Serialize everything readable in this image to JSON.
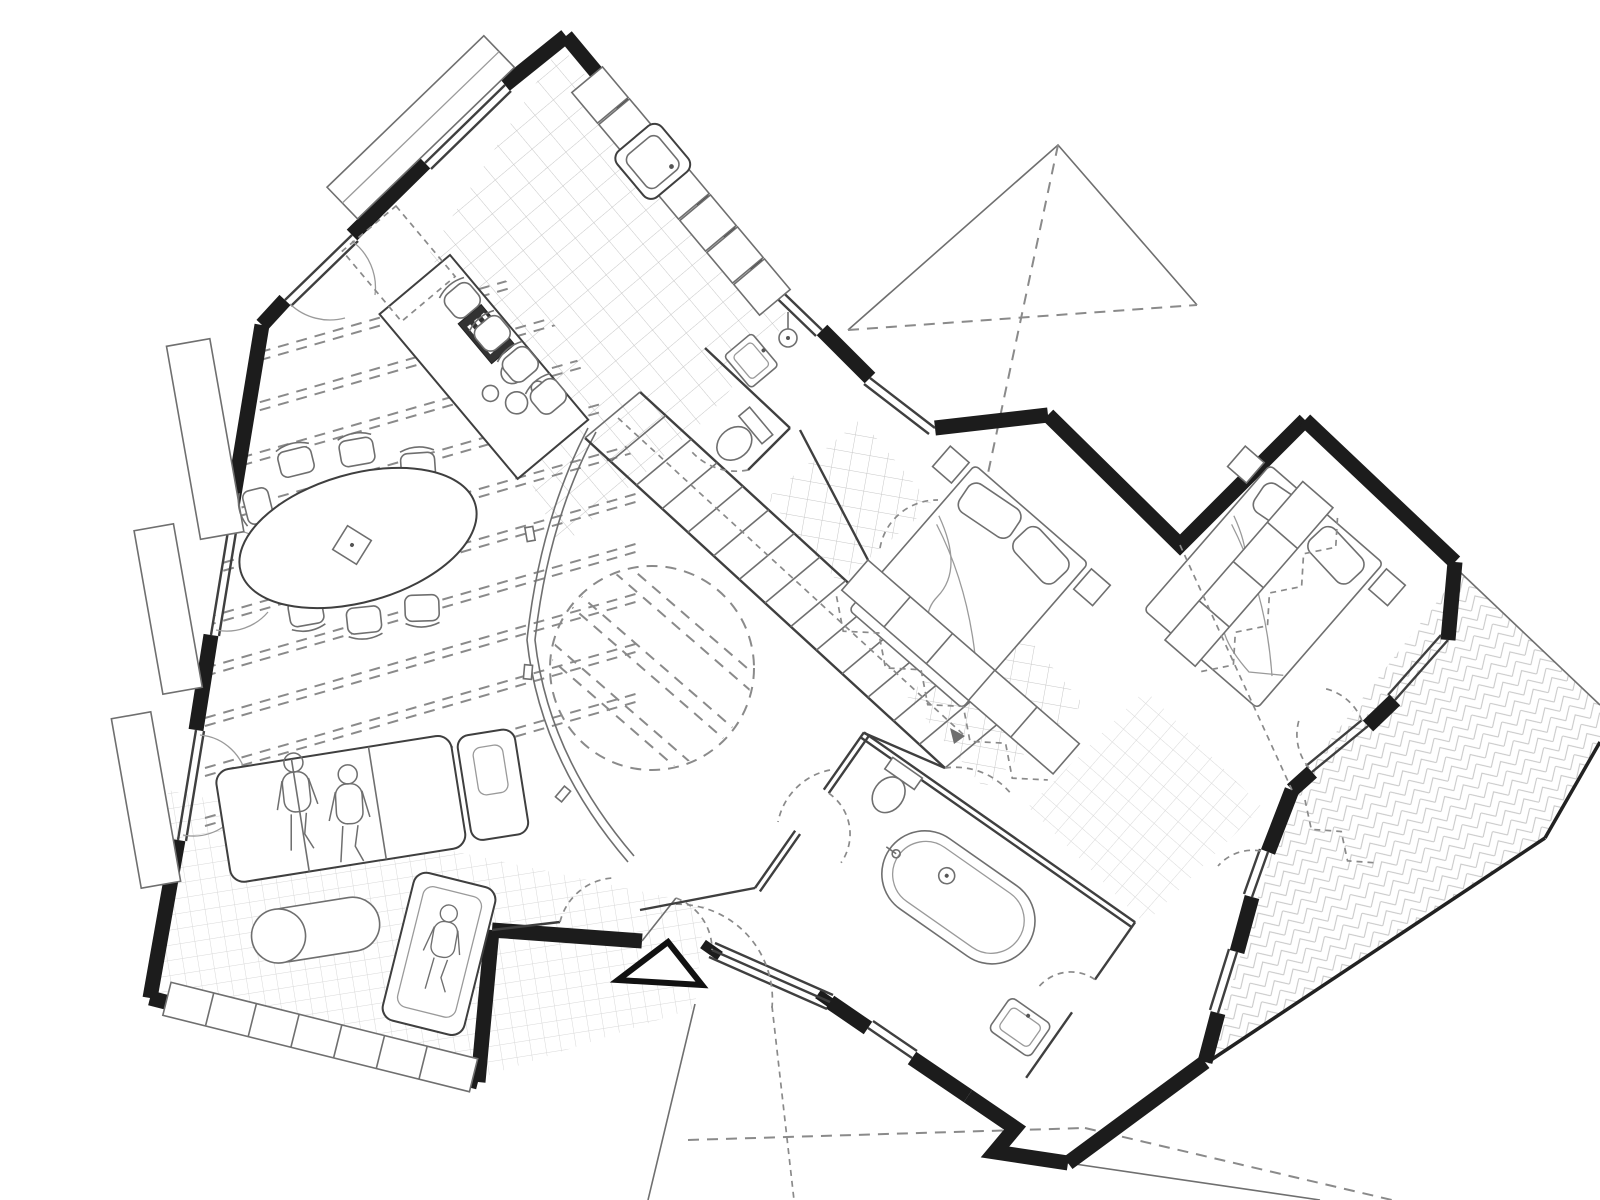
{
  "meta": {
    "type": "architectural-floor-plan",
    "view": "rotated-ground-floor-plan",
    "annotations_text": "none-visible"
  },
  "colors": {
    "background": "#ffffff",
    "wall": "#1c1c1c",
    "line_strong": "#3f3f3f",
    "line_medium": "#6f6f6f",
    "line_light": "#9a9a9a",
    "tile": "#c7c7c7",
    "tile_fine": "#d8d8d8",
    "dash": "#8a8a8a"
  },
  "counts": {
    "dining_chairs": 8,
    "bar_stools": 4,
    "cooktop_burners": 4,
    "beds": 2,
    "human_figures": 3,
    "stair_treads": 13,
    "window_planters": 4,
    "wardrobe_runs": 2
  },
  "features": {
    "left_wing": [
      "kitchen-tiled-floor",
      "kitchen-counter-run",
      "kitchen-sink",
      "kitchen-island",
      "cooktop",
      "bar-stools",
      "dining-table-oval",
      "dining-chairs",
      "ceiling-beams-dashed",
      "sofa-sectional",
      "ottoman",
      "lounge-chair",
      "area-rug-grid",
      "sideboard-band",
      "window-planters",
      "french-door-arcs"
    ],
    "center": [
      "staircase-diagonal",
      "stair-walkline-arrow",
      "void-circle-dashed",
      "wc-toilet",
      "wc-basin",
      "hall-curved-edge",
      "entrance-door",
      "entrance-glazing",
      "entrance-triangle-marker"
    ],
    "right_wing": [
      "bedroom-1-double-bed",
      "bedroom-2-double-bed",
      "wardrobe-bands",
      "hanging-clothes-zigzag",
      "master-rug-grid",
      "bathroom-freestanding-tub",
      "bathroom-toilet",
      "bathroom-basin",
      "terrace-herringbone",
      "carport-x-outline",
      "site-boundary-dashes"
    ]
  }
}
